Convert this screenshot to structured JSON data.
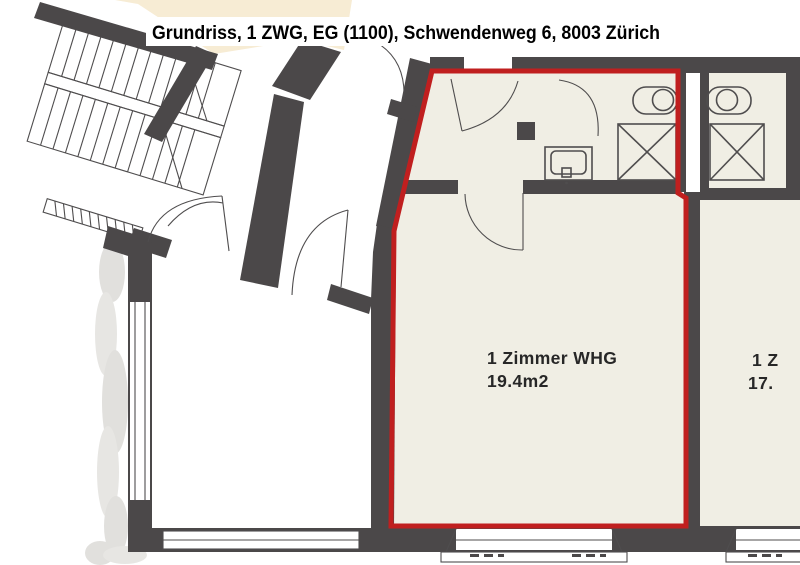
{
  "title": "Grundriss, 1 ZWG, EG (1100), Schwendenweg 6, 8003 Zürich",
  "highlighted_unit": {
    "label": "1 Zimmer WHG",
    "area": "19.4m2"
  },
  "adjacent_unit": {
    "label": "1 Z",
    "area": "17."
  },
  "colors": {
    "highlight": "#c01f1f",
    "wall": "#4b4849",
    "floor": "#f0eee4",
    "floor_accent": "#f7ecd4",
    "line": "#4f4d4e"
  }
}
